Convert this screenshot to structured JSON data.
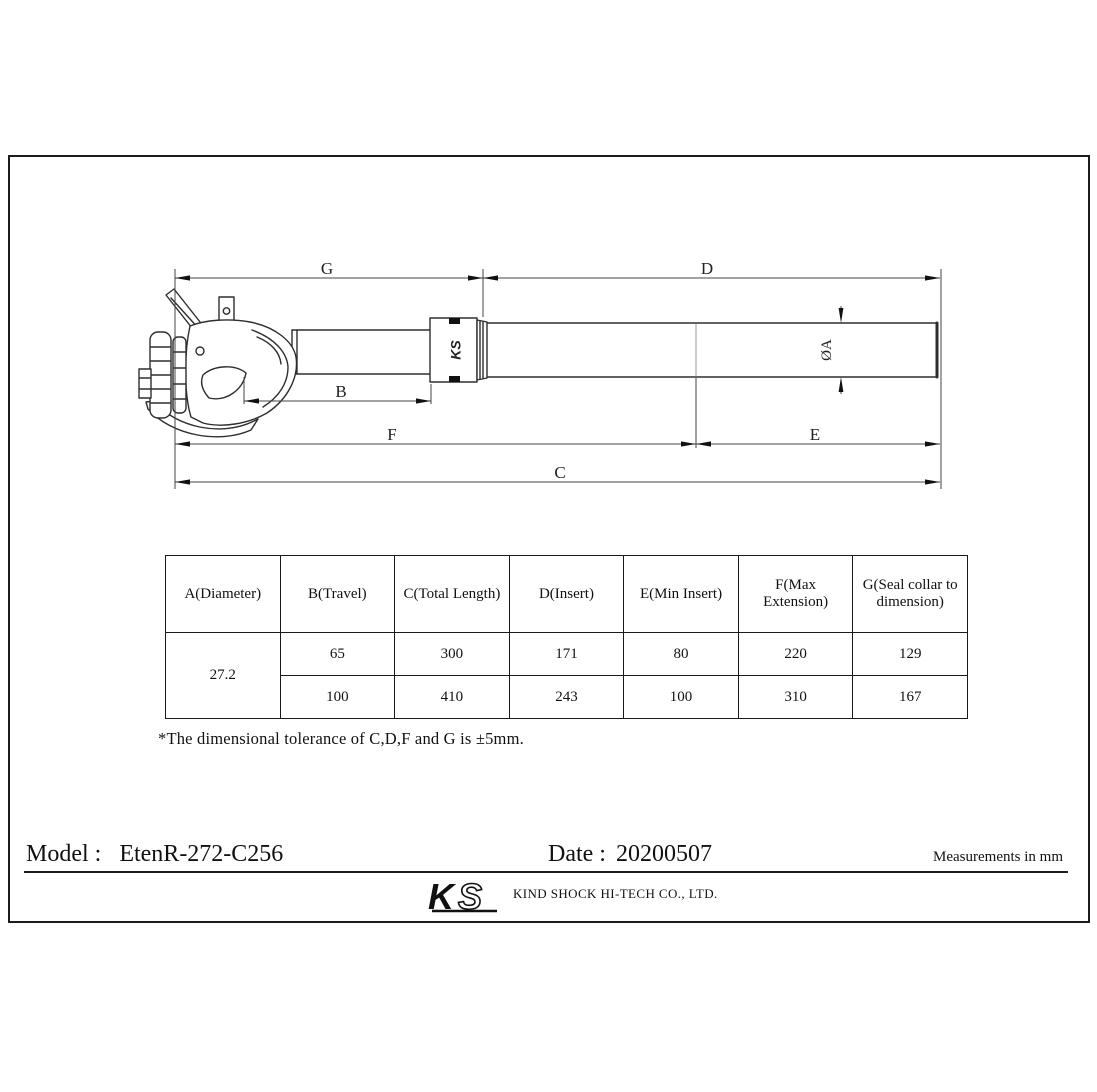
{
  "drawing": {
    "labels": {
      "g": "G",
      "d": "D",
      "b": "B",
      "f": "F",
      "e": "E",
      "c": "C",
      "dia": "ØA"
    },
    "collar_mark": "KS"
  },
  "table": {
    "headers": [
      "A(Diameter)",
      "B(Travel)",
      "C(Total Length)",
      "D(Insert)",
      "E(Min Insert)",
      "F(Max Extension)",
      "G(Seal collar to dimension)"
    ],
    "diameter": "27.2",
    "rows": [
      {
        "b": "65",
        "c": "300",
        "d": "171",
        "e": "80",
        "f": "220",
        "g": "129"
      },
      {
        "b": "100",
        "c": "410",
        "d": "243",
        "e": "100",
        "f": "310",
        "g": "167"
      }
    ]
  },
  "note": "*The dimensional tolerance of C,D,F and G is ±5mm.",
  "footer": {
    "model_label": "Model :",
    "model_value": "EtenR-272-C256",
    "date_label": "Date :",
    "date_value": "20200507",
    "units": "Measurements in mm",
    "logo": {
      "k": "K",
      "s": "S"
    },
    "company": "KIND SHOCK HI-TECH CO., LTD."
  }
}
